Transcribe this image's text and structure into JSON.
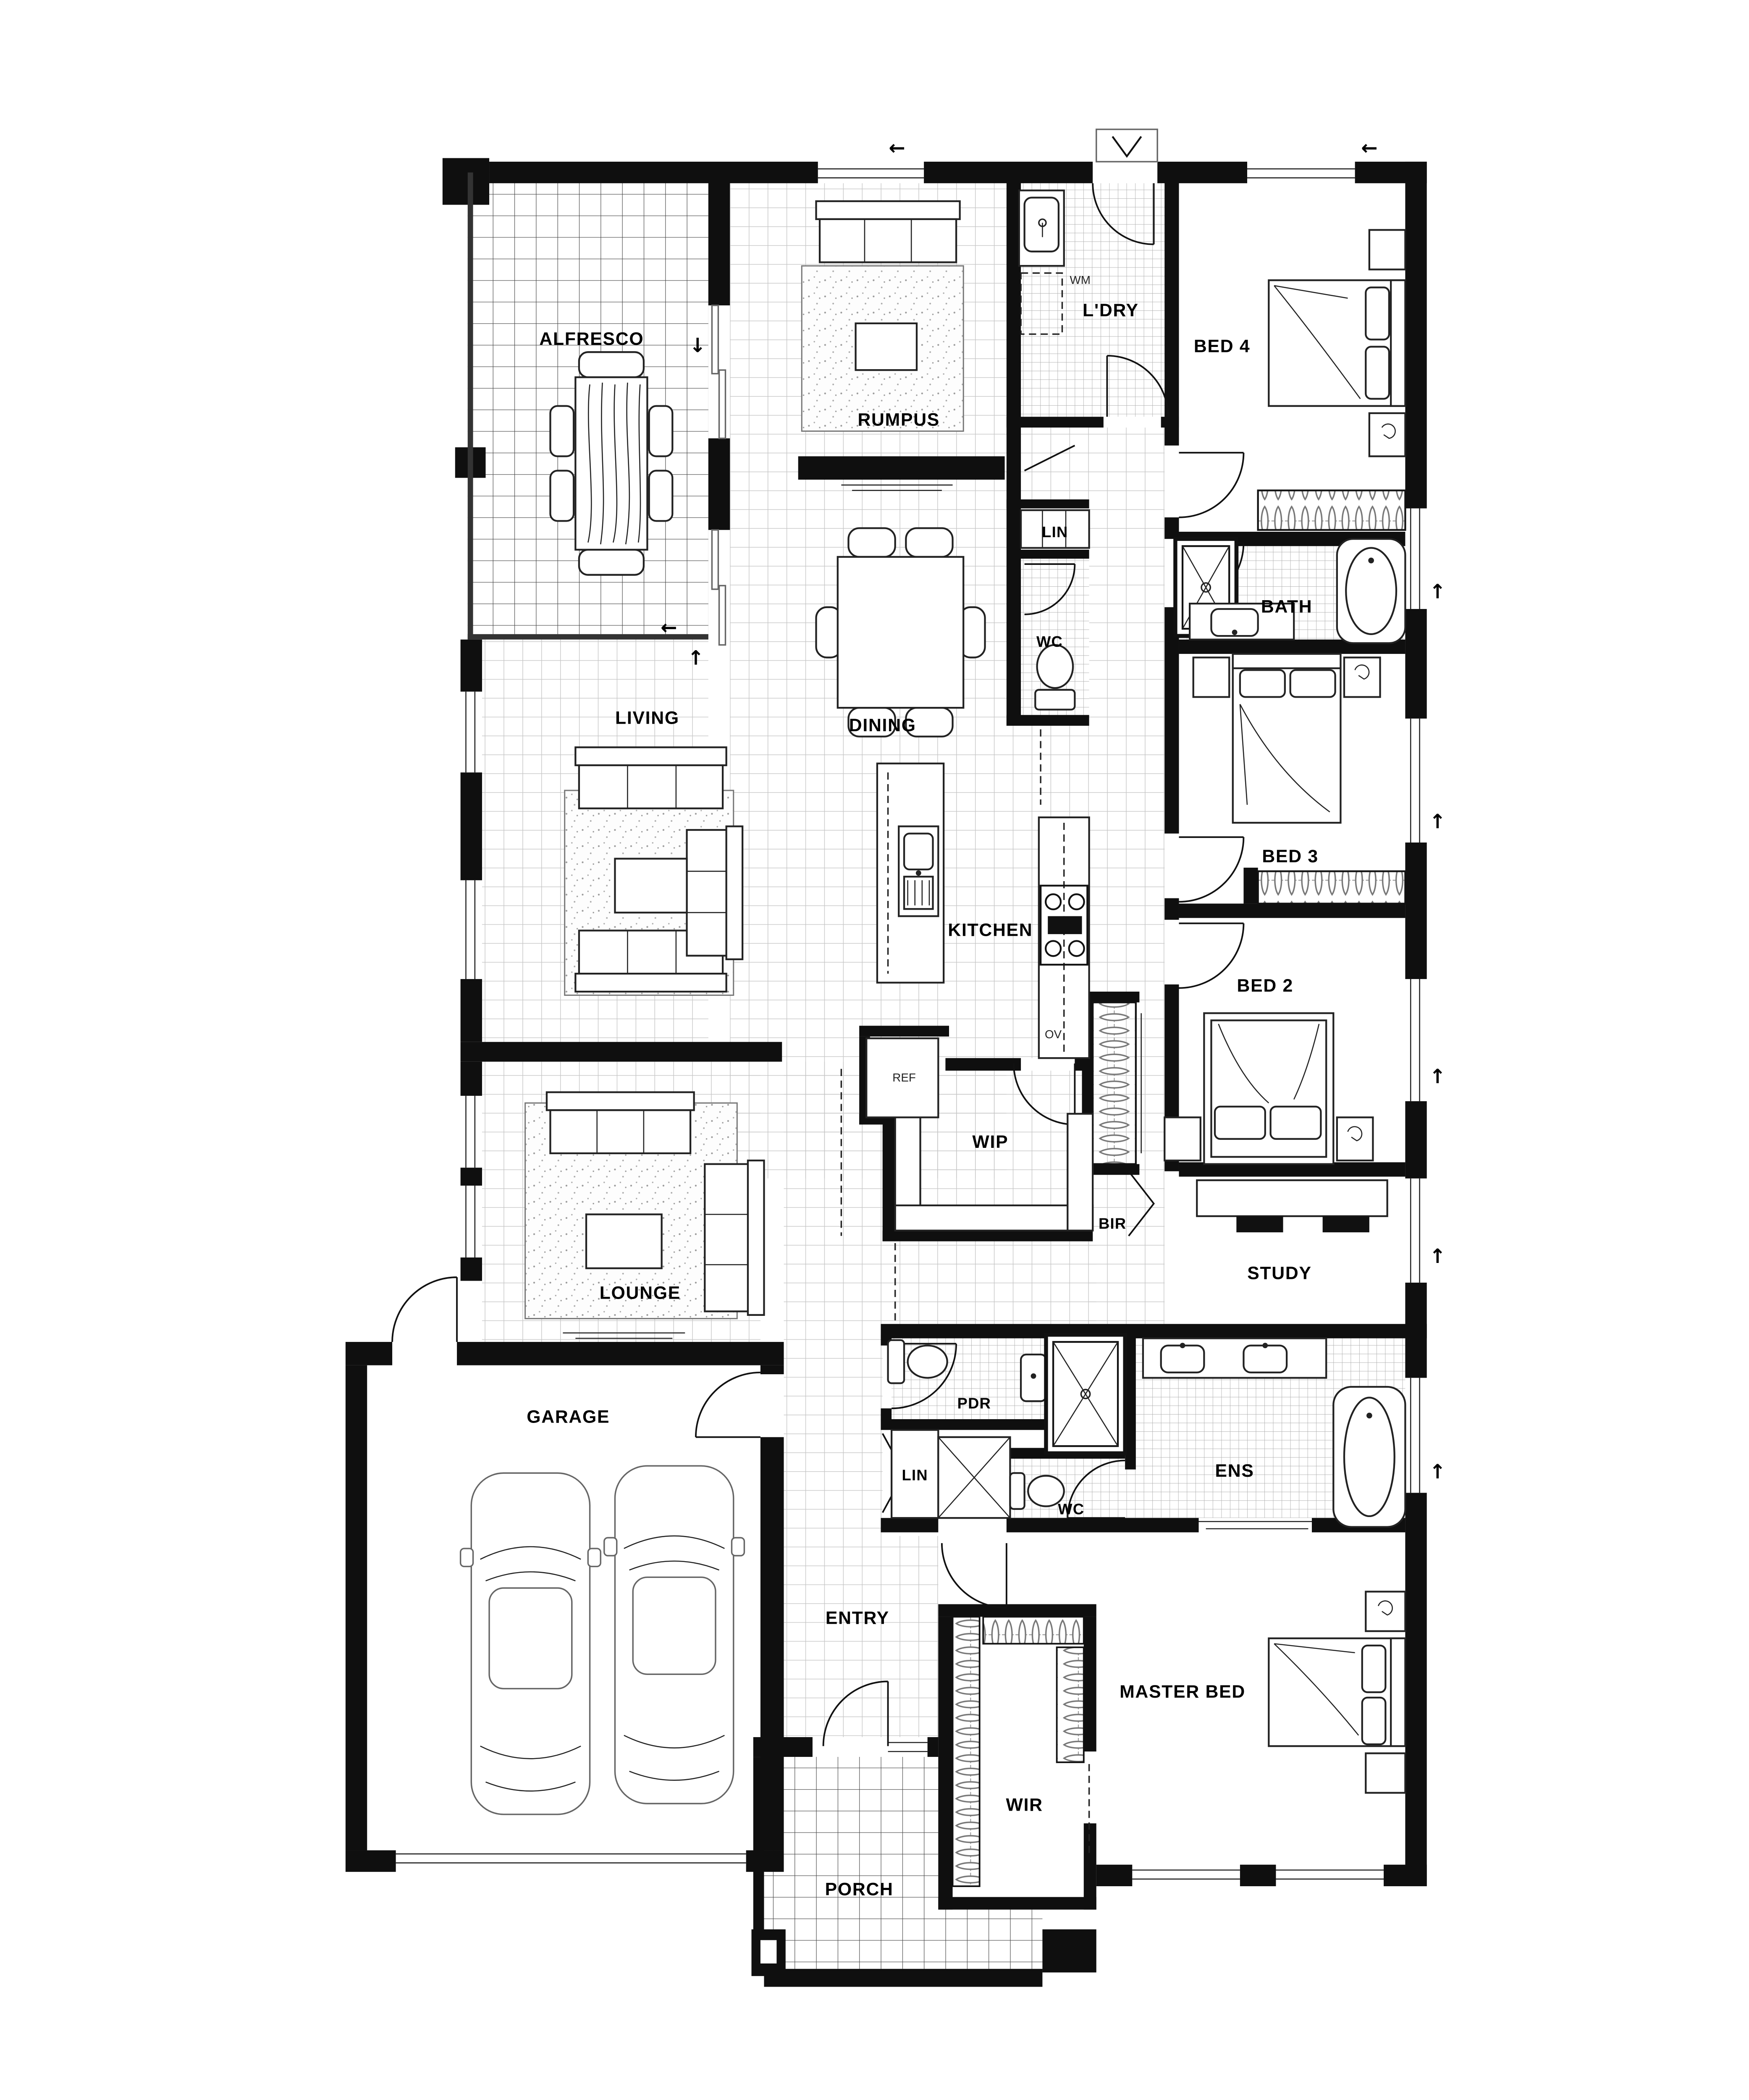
{
  "labels": {
    "alfresco": "ALFRESCO",
    "rumpus": "RUMPUS",
    "ldry": "L'DRY",
    "wm": "WM",
    "bed4": "BED 4",
    "lin_top": "LIN",
    "wc_top": "WC",
    "bath": "BATH",
    "dining": "DINING",
    "living": "LIVING",
    "kitchen": "KITCHEN",
    "ov": "OV",
    "ref": "REF",
    "wip": "WIP",
    "bir": "BIR",
    "bed3": "BED 3",
    "bed2": "BED 2",
    "study": "STUDY",
    "lounge": "LOUNGE",
    "garage": "GARAGE",
    "pdr": "PDR",
    "lin_hall": "LIN",
    "wc_ens": "WC",
    "ens": "ENS",
    "entry": "ENTRY",
    "wir": "WIR",
    "master": "MASTER BED",
    "porch": "PORCH"
  },
  "arrows": {
    "left": "←",
    "up": "↑",
    "down": "↓"
  }
}
